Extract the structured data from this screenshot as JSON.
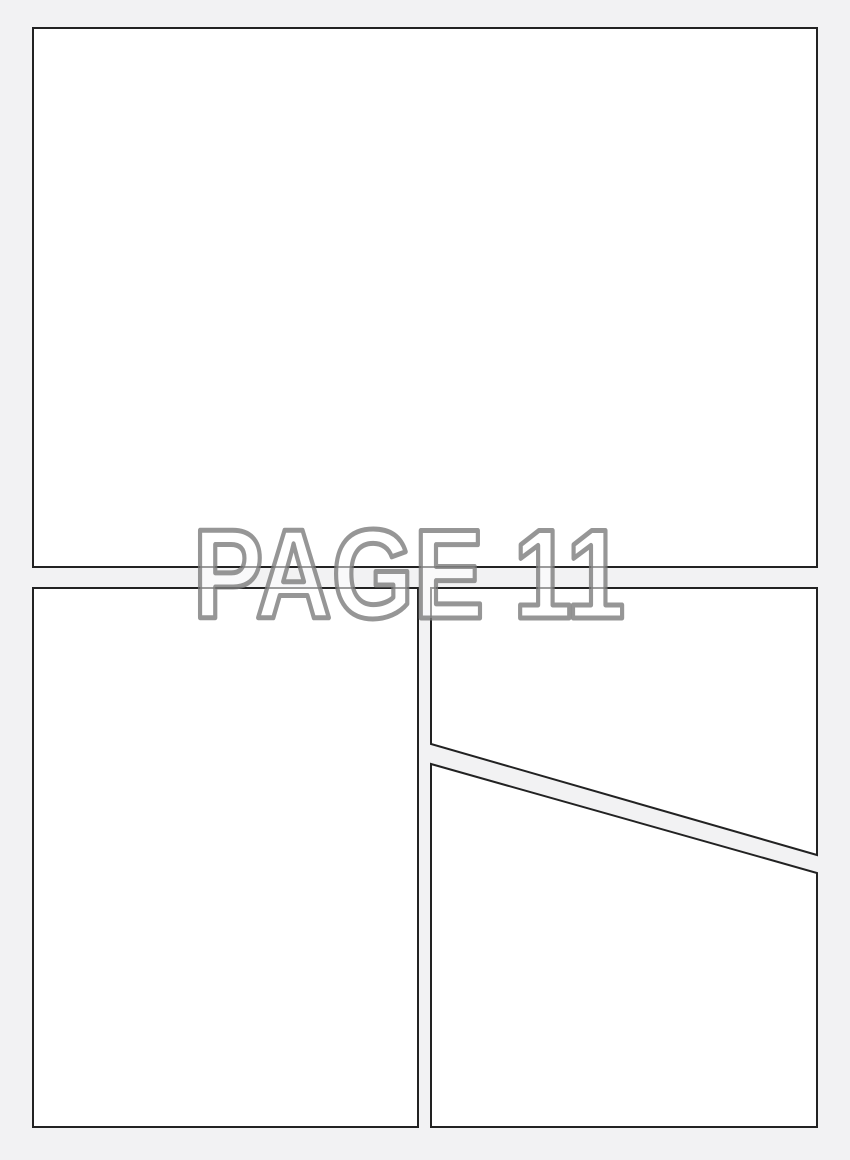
{
  "page": {
    "watermark_label": "PAGE 11"
  },
  "panels": [
    {
      "id": "panel-1",
      "position": "top full-width",
      "shape": "rectangle"
    },
    {
      "id": "panel-2",
      "position": "bottom-left",
      "shape": "rectangle"
    },
    {
      "id": "panel-3",
      "position": "bottom-right upper",
      "shape": "quadrilateral, diagonal bottom edge sloping down to the right"
    },
    {
      "id": "panel-4",
      "position": "bottom-right lower",
      "shape": "quadrilateral, diagonal top edge sloping down to the right"
    }
  ],
  "colors": {
    "canvas_background": "#f2f2f3",
    "panel_fill": "#ffffff",
    "panel_border": "#222222",
    "watermark_fill": "rgba(255,255,255,0.55)",
    "watermark_stroke": "rgba(124,124,124,0.8)"
  }
}
